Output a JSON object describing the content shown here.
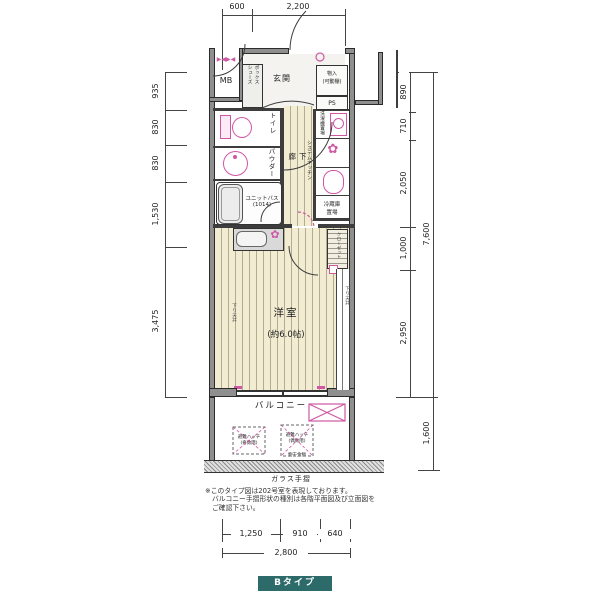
{
  "dimensions": {
    "top": [
      "600",
      "2,200"
    ],
    "left": [
      "935",
      "830",
      "830",
      "1,530",
      "3,475"
    ],
    "right": [
      "890",
      "710",
      "2,050",
      "1,000",
      "2,950"
    ],
    "right_total": "7,600",
    "balcony_depth": "1,600",
    "bottom": [
      "1,250",
      "910",
      "640"
    ],
    "bottom_total": "2,800"
  },
  "rooms": {
    "mb": "MB",
    "entrance": "玄関",
    "shoe_box_col1": "シューズ",
    "shoe_box_col2": "ボックス",
    "storage_line1": "物入",
    "storage_line2": "(可動棚)",
    "ps": "PS",
    "toilet": "トイレ",
    "powder": "パウダー",
    "unit_bath_line1": "ユニットバス",
    "unit_bath_line2": "(1014)",
    "hallway": "廊下",
    "laundry": "洗濯機置場",
    "kitchen": "システムキッチン",
    "fridge_line1": "冷蔵庫",
    "fridge_line2": "置場",
    "closet": "クローゼット",
    "western_room": "洋室",
    "western_room_size": "(約6.0帖)",
    "balcony": "バルコニー",
    "down_ceiling": "下り天井"
  },
  "annotations": {
    "hatch_odd_line1": "避難ハッチ",
    "hatch_odd_line2": "(奇数階)",
    "hatch_even_line1": "避難ハッチ",
    "hatch_even_line2": "(偶数階)",
    "laundry_bracket": "物干金物",
    "glass_rail": "ガラス手摺",
    "note_line1": "※このタイプ図は202号室を表現しております。",
    "note_line2": "バルコニー手摺形状の種別は各階平面図及び立面図を",
    "note_line3": "ご確認下さい。"
  },
  "icons": {
    "meter_valves": "▶◀▶◀",
    "burner": "✿",
    "burner_small": "✿"
  },
  "footer": {
    "type_label": "Bタイプ"
  },
  "colors": {
    "accent_pink": "#cf57a3",
    "badge_teal": "#2d6a6a",
    "floor_cream": "#f2ecd2",
    "wall_grey": "#8f8f8f"
  }
}
